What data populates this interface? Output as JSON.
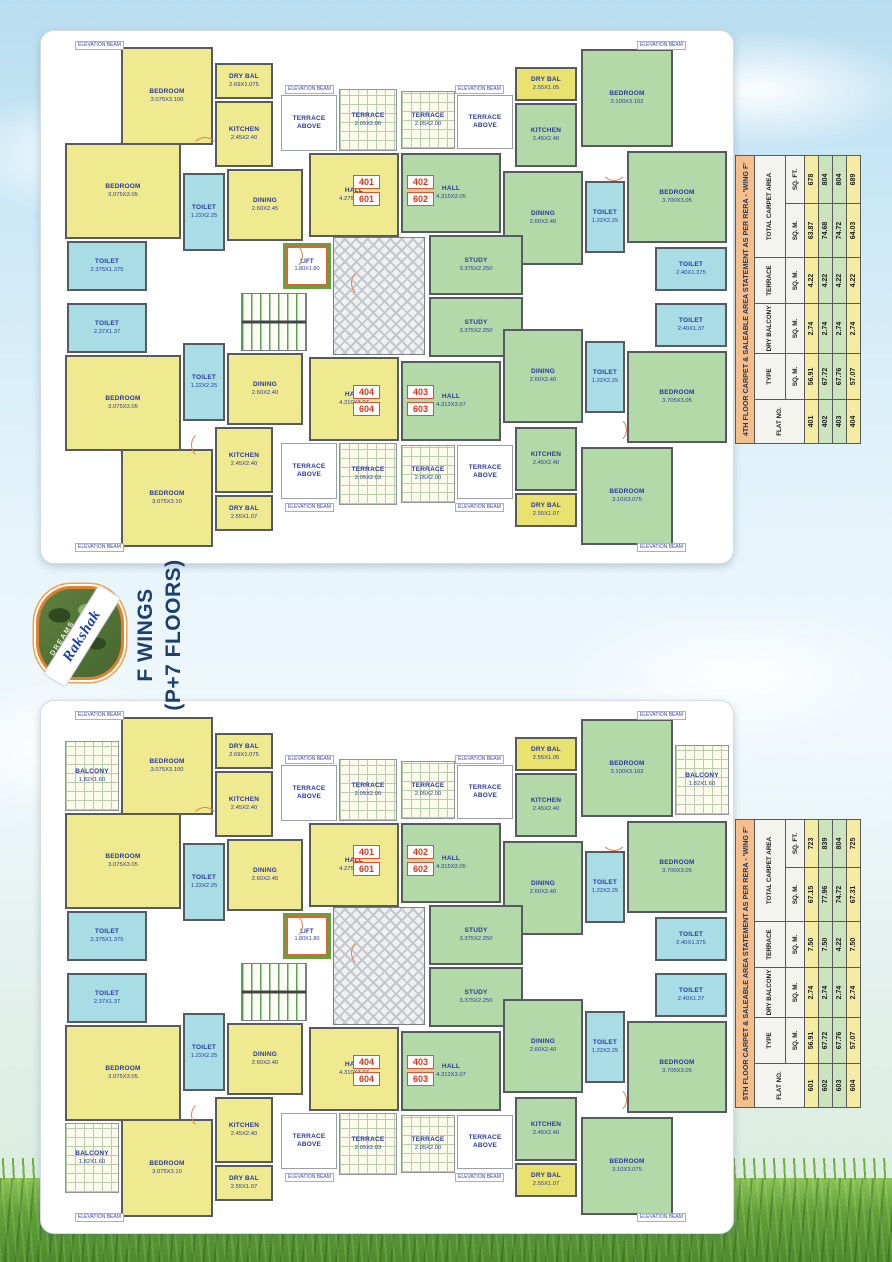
{
  "branding": {
    "logo_top": "DREAMS",
    "logo_name": "Rakshak",
    "wing_line1": "F WINGS",
    "wing_line2": "(P+7 FLOORS)"
  },
  "beam_label": "ELEVATION BEAM",
  "floor_plans": {
    "rooms_common": [
      {
        "n": "BEDROOM",
        "d": "3.075X3.100",
        "x": 80,
        "y": 16,
        "w": 92,
        "h": 98,
        "t": "y"
      },
      {
        "n": "DRY BAL",
        "d": "2.69X1.075",
        "x": 174,
        "y": 32,
        "w": 58,
        "h": 36,
        "t": "y"
      },
      {
        "n": "KITCHEN",
        "d": "2.45X2.40",
        "x": 174,
        "y": 70,
        "w": 58,
        "h": 66,
        "t": "y"
      },
      {
        "n": "TERRACE ABOVE",
        "d": "",
        "x": 240,
        "y": 64,
        "w": 56,
        "h": 56,
        "t": "w"
      },
      {
        "n": "TERRACE",
        "d": "2.05X2.00",
        "x": 298,
        "y": 58,
        "w": 58,
        "h": 62,
        "t": "grid"
      },
      {
        "n": "TERRACE",
        "d": "2.05X2.00",
        "x": 360,
        "y": 60,
        "w": 54,
        "h": 58,
        "t": "grid"
      },
      {
        "n": "TERRACE ABOVE",
        "d": "",
        "x": 416,
        "y": 64,
        "w": 56,
        "h": 54,
        "t": "w"
      },
      {
        "n": "DRY BAL",
        "d": "2.55X1.05",
        "x": 474,
        "y": 36,
        "w": 62,
        "h": 34,
        "t": "dy"
      },
      {
        "n": "KITCHEN",
        "d": "2.45X2.40",
        "x": 474,
        "y": 72,
        "w": 62,
        "h": 64,
        "t": "g"
      },
      {
        "n": "BEDROOM",
        "d": "3.100X3.102",
        "x": 540,
        "y": 18,
        "w": 92,
        "h": 98,
        "t": "g"
      },
      {
        "n": "BEDROOM",
        "d": "3.075X3.05",
        "x": 24,
        "y": 112,
        "w": 116,
        "h": 96,
        "t": "y"
      },
      {
        "n": "TOILET",
        "d": "1.22X2.25",
        "x": 142,
        "y": 142,
        "w": 42,
        "h": 78,
        "t": "t"
      },
      {
        "n": "DINING",
        "d": "2.60X2.45",
        "x": 186,
        "y": 138,
        "w": 76,
        "h": 72,
        "t": "y"
      },
      {
        "n": "HALL",
        "d": "4.275X3.05",
        "x": 268,
        "y": 122,
        "w": 90,
        "h": 84,
        "t": "y"
      },
      {
        "n": "TOILET",
        "d": "2.375X1.375",
        "x": 26,
        "y": 210,
        "w": 80,
        "h": 50,
        "t": "t"
      },
      {
        "n": "LIFT",
        "d": "1.80X1.80",
        "x": 242,
        "y": 212,
        "w": 48,
        "h": 46,
        "t": "lift"
      },
      {
        "n": "",
        "d": "",
        "x": 200,
        "y": 262,
        "w": 66,
        "h": 58,
        "t": "stairs"
      },
      {
        "n": "",
        "d": "",
        "x": 292,
        "y": 206,
        "w": 92,
        "h": 118,
        "t": "lobby"
      },
      {
        "n": "HALL",
        "d": "4.315X3.05",
        "x": 360,
        "y": 122,
        "w": 100,
        "h": 80,
        "t": "g"
      },
      {
        "n": "DINING",
        "d": "2.60X2.40",
        "x": 462,
        "y": 140,
        "w": 80,
        "h": 94,
        "t": "g"
      },
      {
        "n": "TOILET",
        "d": "1.22X2.25",
        "x": 544,
        "y": 150,
        "w": 40,
        "h": 72,
        "t": "t"
      },
      {
        "n": "BEDROOM",
        "d": "3.700X3.05",
        "x": 586,
        "y": 120,
        "w": 100,
        "h": 92,
        "t": "g"
      },
      {
        "n": "TOILET",
        "d": "2.40X1.375",
        "x": 614,
        "y": 216,
        "w": 72,
        "h": 44,
        "t": "t"
      },
      {
        "n": "STUDY",
        "d": "3.375X2.250",
        "x": 388,
        "y": 204,
        "w": 94,
        "h": 60,
        "t": "g"
      },
      {
        "n": "STUDY",
        "d": "3.375X2.250",
        "x": 388,
        "y": 266,
        "w": 94,
        "h": 60,
        "t": "g"
      },
      {
        "n": "TOILET",
        "d": "2.37X1.37",
        "x": 26,
        "y": 272,
        "w": 80,
        "h": 50,
        "t": "t"
      },
      {
        "n": "BEDROOM",
        "d": "3.075X3.05",
        "x": 24,
        "y": 324,
        "w": 116,
        "h": 96,
        "t": "y"
      },
      {
        "n": "TOILET",
        "d": "1.22X2.25",
        "x": 142,
        "y": 312,
        "w": 42,
        "h": 78,
        "t": "t"
      },
      {
        "n": "DINING",
        "d": "2.60X2.40",
        "x": 186,
        "y": 322,
        "w": 76,
        "h": 72,
        "t": "y"
      },
      {
        "n": "HALL",
        "d": "4.310X3.07",
        "x": 268,
        "y": 326,
        "w": 90,
        "h": 84,
        "t": "y"
      },
      {
        "n": "BEDROOM",
        "d": "3.075X3.10",
        "x": 80,
        "y": 418,
        "w": 92,
        "h": 98,
        "t": "y"
      },
      {
        "n": "KITCHEN",
        "d": "2.45X2.40",
        "x": 174,
        "y": 396,
        "w": 58,
        "h": 66,
        "t": "y"
      },
      {
        "n": "DRY BAL",
        "d": "2.55X1.07",
        "x": 174,
        "y": 464,
        "w": 58,
        "h": 36,
        "t": "y"
      },
      {
        "n": "TERRACE ABOVE",
        "d": "",
        "x": 240,
        "y": 412,
        "w": 56,
        "h": 56,
        "t": "w"
      },
      {
        "n": "TERRACE",
        "d": "2.05X2.03",
        "x": 298,
        "y": 412,
        "w": 58,
        "h": 62,
        "t": "grid"
      },
      {
        "n": "TERRACE",
        "d": "2.05X2.00",
        "x": 360,
        "y": 414,
        "w": 54,
        "h": 58,
        "t": "grid"
      },
      {
        "n": "TERRACE ABOVE",
        "d": "",
        "x": 416,
        "y": 414,
        "w": 56,
        "h": 54,
        "t": "w"
      },
      {
        "n": "DRY BAL",
        "d": "2.55X1.07",
        "x": 474,
        "y": 462,
        "w": 62,
        "h": 34,
        "t": "dy"
      },
      {
        "n": "KITCHEN",
        "d": "2.45X2.40",
        "x": 474,
        "y": 396,
        "w": 62,
        "h": 64,
        "t": "g"
      },
      {
        "n": "BEDROOM",
        "d": "3.10X3.075",
        "x": 540,
        "y": 416,
        "w": 92,
        "h": 98,
        "t": "g"
      },
      {
        "n": "HALL",
        "d": "4.312X3.07",
        "x": 360,
        "y": 330,
        "w": 100,
        "h": 80,
        "t": "g"
      },
      {
        "n": "DINING",
        "d": "2.60X2.40",
        "x": 462,
        "y": 298,
        "w": 80,
        "h": 94,
        "t": "g"
      },
      {
        "n": "TOILET",
        "d": "1.22X2.25",
        "x": 544,
        "y": 310,
        "w": 40,
        "h": 72,
        "t": "t"
      },
      {
        "n": "BEDROOM",
        "d": "3.705X3.05",
        "x": 586,
        "y": 320,
        "w": 100,
        "h": 92,
        "t": "g"
      },
      {
        "n": "TOILET",
        "d": "2.40X1.37",
        "x": 614,
        "y": 272,
        "w": 72,
        "h": 44,
        "t": "t"
      }
    ],
    "badges": [
      {
        "labels": [
          "401",
          "601"
        ],
        "x": 312,
        "y": 144
      },
      {
        "labels": [
          "402",
          "602"
        ],
        "x": 366,
        "y": 144
      },
      {
        "labels": [
          "404",
          "604"
        ],
        "x": 312,
        "y": 354
      },
      {
        "labels": [
          "403",
          "603"
        ],
        "x": 366,
        "y": 354
      }
    ],
    "beam_positions": [
      {
        "x": 34,
        "y": 10
      },
      {
        "x": 244,
        "y": 54
      },
      {
        "x": 414,
        "y": 54
      },
      {
        "x": 596,
        "y": 10
      },
      {
        "x": 34,
        "y": 512
      },
      {
        "x": 244,
        "y": 472
      },
      {
        "x": 414,
        "y": 472
      },
      {
        "x": 596,
        "y": 512
      }
    ],
    "door_arcs": [
      {
        "x": 150,
        "y": 106,
        "r": 26,
        "rot": 0
      },
      {
        "x": 236,
        "y": 212,
        "r": 24,
        "rot": 90
      },
      {
        "x": 560,
        "y": 124,
        "r": 24,
        "rot": 180
      },
      {
        "x": 310,
        "y": 238,
        "r": 26,
        "rot": 270
      },
      {
        "x": 150,
        "y": 400,
        "r": 26,
        "rot": 270
      },
      {
        "x": 560,
        "y": 386,
        "r": 24,
        "rot": 90
      }
    ],
    "plans": [
      {
        "id": "plan-4th-floor",
        "extra_rooms": []
      },
      {
        "id": "plan-5th-floor",
        "extra_rooms": [
          {
            "n": "BALCONY",
            "d": "1.82X1.60",
            "x": 24,
            "y": 40,
            "w": 54,
            "h": 70,
            "t": "grid"
          },
          {
            "n": "BALCONY",
            "d": "1.82X1.60",
            "x": 634,
            "y": 44,
            "w": 54,
            "h": 70,
            "t": "grid"
          },
          {
            "n": "BALCONY",
            "d": "1.82X1.60",
            "x": 24,
            "y": 422,
            "w": 54,
            "h": 70,
            "t": "grid"
          }
        ]
      }
    ]
  },
  "area_tables": [
    {
      "title": "4TH FLOOR CARPET & SALEABLE AREA STATEMENT AS PER RERA - 'WING F'",
      "col_headers": [
        "FLAT NO.",
        "TYPE",
        "DRY BALCONY",
        "TERRACE",
        "TOTAL CARPET AREA"
      ],
      "unit_row": [
        "SQ. M.",
        "SQ. M.",
        "SQ. M.",
        "SQ. M.",
        "SQ. FT."
      ],
      "rows": [
        {
          "flat": "401",
          "type_sqm": "56.91",
          "dry_balcony": "2.74",
          "terrace": "4.22",
          "total_sqm": "63.87",
          "total_sqft": "678",
          "tone": "y"
        },
        {
          "flat": "402",
          "type_sqm": "67.72",
          "dry_balcony": "2.74",
          "terrace": "4.22",
          "total_sqm": "74.68",
          "total_sqft": "804",
          "tone": "g"
        },
        {
          "flat": "403",
          "type_sqm": "67.76",
          "dry_balcony": "2.74",
          "terrace": "4.22",
          "total_sqm": "74.72",
          "total_sqft": "804",
          "tone": "g"
        },
        {
          "flat": "404",
          "type_sqm": "57.07",
          "dry_balcony": "2.74",
          "terrace": "4.22",
          "total_sqm": "64.03",
          "total_sqft": "689",
          "tone": "y"
        }
      ]
    },
    {
      "title": "5TH FLOOR CARPET & SALEABLE AREA STATEMENT AS PER RERA - 'WING F'",
      "col_headers": [
        "FLAT NO.",
        "TYPE",
        "DRY BALCONY",
        "TERRACE",
        "TOTAL CARPET AREA"
      ],
      "unit_row": [
        "SQ. M.",
        "SQ. M.",
        "SQ. M.",
        "SQ. M.",
        "SQ. FT."
      ],
      "rows": [
        {
          "flat": "601",
          "type_sqm": "56.91",
          "dry_balcony": "2.74",
          "terrace": "7.50",
          "total_sqm": "67.15",
          "total_sqft": "723",
          "tone": "y"
        },
        {
          "flat": "602",
          "type_sqm": "67.72",
          "dry_balcony": "2.74",
          "terrace": "7.50",
          "total_sqm": "77.96",
          "total_sqft": "839",
          "tone": "g"
        },
        {
          "flat": "603",
          "type_sqm": "67.76",
          "dry_balcony": "2.74",
          "terrace": "4.22",
          "total_sqm": "74.72",
          "total_sqft": "804",
          "tone": "g"
        },
        {
          "flat": "604",
          "type_sqm": "57.07",
          "dry_balcony": "2.74",
          "terrace": "7.50",
          "total_sqm": "67.31",
          "total_sqft": "725",
          "tone": "y"
        }
      ]
    }
  ]
}
